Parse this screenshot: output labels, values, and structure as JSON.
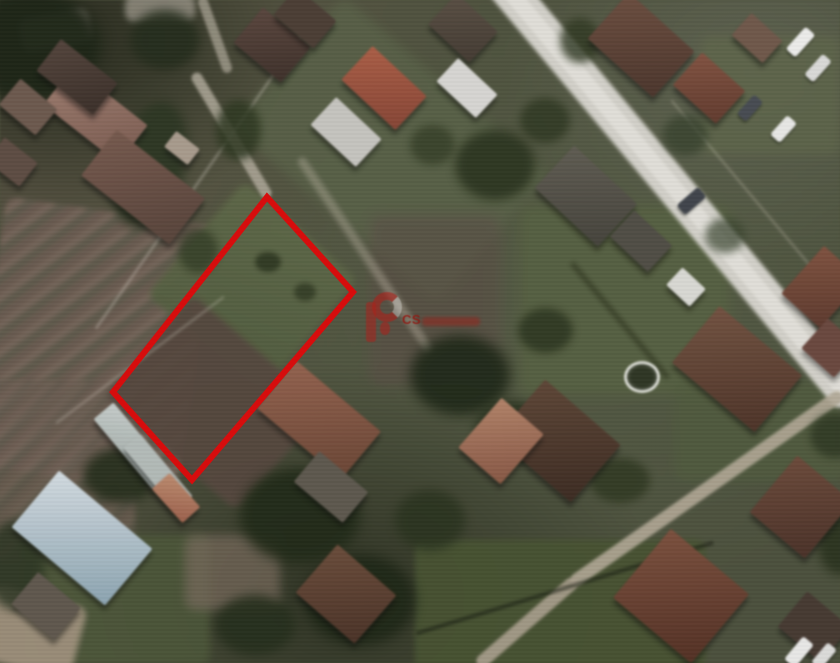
{
  "meta": {
    "kind": "aerial-photo-with-plot-outline",
    "width": 840,
    "height": 663
  },
  "watermark": {
    "text": "CS",
    "logo_color": "#b21e18",
    "word_color": "rgba(160,30,22,0.5)"
  },
  "plot_outline": {
    "points": "267,197 353,292 192,480 113,392",
    "stroke": "#d60d0d",
    "stroke_width": 6
  },
  "scene": {
    "fields": [
      {
        "n": "plowed-field-left",
        "x": 92,
        "y": 345,
        "w": 210,
        "h": 270,
        "rot": 8,
        "bg": "repeating-linear-gradient(135deg,#6c5a4f 0px 8px,#79665a 8px 14px,#60594b 14px 22px)",
        "op": 0.9,
        "blur": 2
      },
      {
        "n": "plowed-field-left-lower",
        "x": 55,
        "y": 470,
        "w": 160,
        "h": 180,
        "rot": 0,
        "bg": "repeating-linear-gradient(135deg,#6c5a4f 0px 8px,#746256 8px 15px,#5e574a 15px 22px)",
        "op": 0.7,
        "blur": 3
      },
      {
        "n": "marked-plot-upper-grass",
        "x": 252,
        "y": 287,
        "w": 150,
        "h": 150,
        "rot": 41,
        "bg": "linear-gradient(160deg,#5d6844,#505c3c)",
        "op": 0.95,
        "blur": 3
      },
      {
        "n": "marked-plot-lower-soil",
        "x": 214,
        "y": 402,
        "w": 175,
        "h": 135,
        "rot": 41,
        "bg": "#55463c",
        "op": 0.95,
        "blur": 3
      },
      {
        "n": "grass-band-top-center",
        "x": 390,
        "y": 150,
        "w": 270,
        "h": 170,
        "rot": 41,
        "bg": "#586245",
        "op": 0.8,
        "blur": 5
      },
      {
        "n": "lawn-right",
        "x": 625,
        "y": 300,
        "w": 210,
        "h": 190,
        "rot": 0,
        "bg": "#55613e",
        "op": 0.85,
        "blur": 6
      },
      {
        "n": "lawn-right-lower",
        "x": 760,
        "y": 430,
        "w": 170,
        "h": 100,
        "rot": 0,
        "bg": "#4f5b3b",
        "op": 0.8,
        "blur": 5
      },
      {
        "n": "green-field-bottom",
        "x": 560,
        "y": 615,
        "w": 290,
        "h": 150,
        "rot": 0,
        "bg": "#45512e",
        "op": 0.95,
        "blur": 3
      },
      {
        "n": "green-bottom-left",
        "x": 115,
        "y": 600,
        "w": 190,
        "h": 130,
        "rot": 0,
        "bg": "#4a5636",
        "op": 0.85,
        "blur": 4
      },
      {
        "n": "dirt-bottom-left-corner",
        "x": 32,
        "y": 632,
        "w": 95,
        "h": 75,
        "rot": 15,
        "bg": "#a2927c",
        "op": 0.9,
        "blur": 3
      },
      {
        "n": "dirt-patch-bottom-center",
        "x": 232,
        "y": 572,
        "w": 95,
        "h": 75,
        "rot": 0,
        "bg": "#79695a",
        "op": 0.7,
        "blur": 5
      },
      {
        "n": "soil-right-of-plot",
        "x": 435,
        "y": 300,
        "w": 130,
        "h": 170,
        "rot": 0,
        "bg": "#5a4c43",
        "op": 0.6,
        "blur": 6
      },
      {
        "n": "lawn-top-right-parking",
        "x": 770,
        "y": 95,
        "w": 140,
        "h": 120,
        "rot": 0,
        "bg": "#5e6747",
        "op": 0.7,
        "blur": 5
      },
      {
        "n": "bare-patch-top-left",
        "x": 55,
        "y": 30,
        "w": 70,
        "h": 35,
        "rot": -10,
        "bg": "#9b958a",
        "op": 0.7,
        "blur": 3
      },
      {
        "n": "bare-patch-top",
        "x": 160,
        "y": 8,
        "w": 70,
        "h": 28,
        "rot": 0,
        "bg": "#a39d90",
        "op": 0.7,
        "blur": 3
      }
    ],
    "roads": [
      {
        "n": "main-road",
        "x": 672,
        "y": 185,
        "w": 560,
        "h": 36,
        "rot": 50,
        "bg": "#d3d1c9",
        "op": 1,
        "blur": 1.5
      },
      {
        "n": "main-road-center",
        "x": 672,
        "y": 185,
        "w": 560,
        "h": 16,
        "rot": 50,
        "bg": "#e3e1da",
        "op": 0.9,
        "blur": 1
      },
      {
        "n": "side-road-lower-right",
        "x": 707,
        "y": 488,
        "w": 330,
        "h": 13,
        "rot": -35,
        "bg": "#b2a894",
        "op": 0.9,
        "blur": 1
      },
      {
        "n": "side-road-bottom",
        "x": 527,
        "y": 622,
        "w": 130,
        "h": 13,
        "rot": -41,
        "bg": "#ab9f8c",
        "op": 0.9,
        "blur": 1
      },
      {
        "n": "lane-to-plot",
        "x": 231,
        "y": 135,
        "w": 145,
        "h": 11,
        "rot": 59,
        "bg": "#b5ae9e",
        "op": 0.8,
        "blur": 1
      },
      {
        "n": "lane-top-stub",
        "x": 215,
        "y": 35,
        "w": 80,
        "h": 10,
        "rot": 70,
        "bg": "#b0a999",
        "op": 0.7,
        "blur": 1
      },
      {
        "n": "dirt-track-center",
        "x": 365,
        "y": 255,
        "w": 235,
        "h": 9,
        "rot": 56,
        "bg": "#a59f8d",
        "op": 0.5,
        "blur": 2
      }
    ],
    "lines": [
      {
        "n": "fence-line-left",
        "x": 202,
        "y": 177,
        "w": 370,
        "h": 2,
        "rot": -55,
        "bg": "rgba(205,200,185,0.5)",
        "op": 1,
        "blur": 1
      },
      {
        "n": "fence-line-greenhouse",
        "x": 140,
        "y": 360,
        "w": 210,
        "h": 2,
        "rot": -37,
        "bg": "rgba(200,195,180,0.4)",
        "op": 1,
        "blur": 1
      },
      {
        "n": "roof-ridge-red-house",
        "x": 384,
        "y": 88,
        "w": 66,
        "h": 3,
        "rot": 43,
        "bg": "rgba(230,222,210,0.8)",
        "op": 1,
        "blur": 0
      },
      {
        "n": "roof-ridge-brown-house",
        "x": 319,
        "y": 418,
        "w": 95,
        "h": 3,
        "rot": 40,
        "bg": "rgba(215,200,180,0.5)",
        "op": 1,
        "blur": 0
      },
      {
        "n": "field-edge-dark",
        "x": 565,
        "y": 588,
        "w": 310,
        "h": 4,
        "rot": -17,
        "bg": "rgba(20,26,12,0.55)",
        "op": 1,
        "blur": 1
      },
      {
        "n": "hedge-dark-right",
        "x": 620,
        "y": 320,
        "w": 150,
        "h": 5,
        "rot": 50,
        "bg": "rgba(25,32,16,0.5)",
        "op": 1,
        "blur": 2
      },
      {
        "n": "fence-along-road",
        "x": 755,
        "y": 200,
        "w": 260,
        "h": 2,
        "rot": 50,
        "bg": "rgba(210,205,190,0.35)",
        "op": 1,
        "blur": 1
      }
    ],
    "trees": [
      {
        "n": "tree-cluster",
        "x": 30,
        "y": 45,
        "w": 140,
        "h": 110,
        "bg": "#1c2414",
        "op": 0.95,
        "blur": 6
      },
      {
        "n": "tree-cluster",
        "x": 165,
        "y": 40,
        "w": 70,
        "h": 60,
        "bg": "#232c1a",
        "op": 0.9,
        "blur": 5
      },
      {
        "n": "tree-band",
        "x": 150,
        "y": 165,
        "w": 70,
        "h": 130,
        "rot": 15,
        "bg": "#2a3520",
        "op": 0.9,
        "blur": 5
      },
      {
        "n": "tree",
        "x": 238,
        "y": 130,
        "w": 45,
        "h": 60,
        "bg": "#2c371f",
        "op": 0.85,
        "blur": 4
      },
      {
        "n": "tree",
        "x": 198,
        "y": 250,
        "w": 40,
        "h": 45,
        "bg": "#313c24",
        "op": 0.8,
        "blur": 4
      },
      {
        "n": "tree-in-plot",
        "x": 268,
        "y": 262,
        "w": 26,
        "h": 20,
        "bg": "#2c361f",
        "op": 0.9,
        "blur": 2
      },
      {
        "n": "tree-in-plot",
        "x": 305,
        "y": 292,
        "w": 22,
        "h": 18,
        "bg": "#303a22",
        "op": 0.85,
        "blur": 2
      },
      {
        "n": "tree-cluster",
        "x": 495,
        "y": 165,
        "w": 80,
        "h": 70,
        "bg": "#29331d",
        "op": 0.9,
        "blur": 5
      },
      {
        "n": "tree",
        "x": 545,
        "y": 120,
        "w": 50,
        "h": 45,
        "bg": "#2e3821",
        "op": 0.85,
        "blur": 4
      },
      {
        "n": "tree",
        "x": 432,
        "y": 145,
        "w": 45,
        "h": 40,
        "bg": "#333d25",
        "op": 0.8,
        "blur": 4
      },
      {
        "n": "tree",
        "x": 580,
        "y": 40,
        "w": 40,
        "h": 45,
        "bg": "#2e3820",
        "op": 0.8,
        "blur": 4
      },
      {
        "n": "tree-cluster",
        "x": 460,
        "y": 375,
        "w": 100,
        "h": 80,
        "bg": "#1f2917",
        "op": 0.95,
        "blur": 6
      },
      {
        "n": "tree",
        "x": 510,
        "y": 430,
        "w": 70,
        "h": 60,
        "bg": "#27311c",
        "op": 0.9,
        "blur": 5
      },
      {
        "n": "tree",
        "x": 545,
        "y": 330,
        "w": 55,
        "h": 45,
        "bg": "#2a341e",
        "op": 0.85,
        "blur": 4
      },
      {
        "n": "tree-cluster",
        "x": 300,
        "y": 515,
        "w": 120,
        "h": 95,
        "bg": "#202a16",
        "op": 0.95,
        "blur": 6
      },
      {
        "n": "tree-cluster",
        "x": 360,
        "y": 600,
        "w": 110,
        "h": 90,
        "bg": "#1d2614",
        "op": 0.95,
        "blur": 6
      },
      {
        "n": "tree",
        "x": 255,
        "y": 625,
        "w": 80,
        "h": 60,
        "bg": "#242e1a",
        "op": 0.9,
        "blur": 5
      },
      {
        "n": "tree",
        "x": 430,
        "y": 520,
        "w": 70,
        "h": 60,
        "bg": "#28321c",
        "op": 0.85,
        "blur": 5
      },
      {
        "n": "tree",
        "x": 120,
        "y": 475,
        "w": 75,
        "h": 55,
        "bg": "#232d19",
        "op": 0.9,
        "blur": 5
      },
      {
        "n": "tree",
        "x": 15,
        "y": 565,
        "w": 60,
        "h": 90,
        "bg": "#2a3420",
        "op": 0.85,
        "blur": 5
      },
      {
        "n": "tree",
        "x": 685,
        "y": 135,
        "w": 45,
        "h": 40,
        "bg": "#34402a",
        "op": 0.75,
        "blur": 4
      },
      {
        "n": "tree",
        "x": 725,
        "y": 235,
        "w": 40,
        "h": 35,
        "bg": "#37432c",
        "op": 0.7,
        "blur": 4
      },
      {
        "n": "tree",
        "x": 835,
        "y": 435,
        "w": 50,
        "h": 45,
        "bg": "#2b351f",
        "op": 0.8,
        "blur": 4
      },
      {
        "n": "tree",
        "x": 620,
        "y": 480,
        "w": 60,
        "h": 45,
        "bg": "#2c361e",
        "op": 0.8,
        "blur": 4
      },
      {
        "n": "tree",
        "x": 840,
        "y": 545,
        "w": 45,
        "h": 60,
        "bg": "#26301a",
        "op": 0.85,
        "blur": 5
      }
    ],
    "houses": [
      {
        "n": "house-rose-roof",
        "x": 95,
        "y": 115,
        "w": 95,
        "h": 48,
        "rot": 38,
        "bg": "linear-gradient(128deg,#a07b6d,#7b5a4e)"
      },
      {
        "n": "house",
        "x": 143,
        "y": 187,
        "w": 112,
        "h": 58,
        "rot": 38,
        "bg": "linear-gradient(128deg,#77584a,#584238)"
      },
      {
        "n": "house",
        "x": 77,
        "y": 77,
        "w": 72,
        "h": 40,
        "rot": 38,
        "bg": "linear-gradient(128deg,#53423a,#3b2e28)"
      },
      {
        "n": "house",
        "x": 28,
        "y": 107,
        "w": 48,
        "h": 34,
        "rot": 40,
        "bg": "#6d584c"
      },
      {
        "n": "house",
        "x": 12,
        "y": 162,
        "w": 42,
        "h": 30,
        "rot": 38,
        "bg": "#5e4b41"
      },
      {
        "n": "shed",
        "x": 182,
        "y": 148,
        "w": 30,
        "h": 20,
        "rot": 38,
        "bg": "#a99a8b"
      },
      {
        "n": "house",
        "x": 272,
        "y": 45,
        "w": 62,
        "h": 46,
        "rot": 40,
        "bg": "linear-gradient(135deg,#5a443c,#3e2f29)"
      },
      {
        "n": "house-red-roof",
        "x": 384,
        "y": 88,
        "w": 74,
        "h": 46,
        "rot": 43,
        "bg": "linear-gradient(135deg,#b05c42,#8a4332)"
      },
      {
        "n": "shed-gray",
        "x": 346,
        "y": 132,
        "w": 62,
        "h": 38,
        "rot": 43,
        "bg": "#c6c4bf"
      },
      {
        "n": "house",
        "x": 305,
        "y": 18,
        "w": 52,
        "h": 36,
        "rot": 40,
        "bg": "#4b3c33"
      },
      {
        "n": "house",
        "x": 463,
        "y": 28,
        "w": 56,
        "h": 42,
        "rot": 43,
        "bg": "linear-gradient(135deg,#5a4e42,#433a31)"
      },
      {
        "n": "building-white",
        "x": 467,
        "y": 88,
        "w": 54,
        "h": 32,
        "rot": 43,
        "bg": "#d7d6d2"
      },
      {
        "n": "house",
        "x": 641,
        "y": 45,
        "w": 88,
        "h": 62,
        "rot": 42,
        "bg": "linear-gradient(135deg,#6e4c3d,#4c342a)"
      },
      {
        "n": "house",
        "x": 709,
        "y": 88,
        "w": 58,
        "h": 44,
        "rot": 42,
        "bg": "linear-gradient(135deg,#84503e,#63392c)"
      },
      {
        "n": "house",
        "x": 757,
        "y": 38,
        "w": 42,
        "h": 30,
        "rot": 42,
        "bg": "#705747"
      },
      {
        "n": "house-gray-roof",
        "x": 586,
        "y": 196,
        "w": 86,
        "h": 58,
        "rot": 43,
        "bg": "linear-gradient(135deg,#5f5b50,#44423a)"
      },
      {
        "n": "house",
        "x": 641,
        "y": 241,
        "w": 52,
        "h": 36,
        "rot": 43,
        "bg": "#4f4c43"
      },
      {
        "n": "house",
        "x": 822,
        "y": 287,
        "w": 52,
        "h": 64,
        "rot": 42,
        "bg": "linear-gradient(135deg,#82503c,#5f382c)"
      },
      {
        "n": "house",
        "x": 831,
        "y": 348,
        "w": 44,
        "h": 40,
        "rot": 42,
        "bg": "#6c463c"
      },
      {
        "n": "white-object",
        "x": 686,
        "y": 287,
        "w": 32,
        "h": 24,
        "rot": 43,
        "bg": "#d9d9d3"
      },
      {
        "n": "house-hip-roof",
        "x": 737,
        "y": 369,
        "w": 108,
        "h": 74,
        "rot": 40,
        "bg": "linear-gradient(135deg,#74503e,#4e3226)"
      },
      {
        "n": "house",
        "x": 558,
        "y": 441,
        "w": 100,
        "h": 76,
        "rot": 41,
        "bg": "linear-gradient(135deg,#5f4434,#3c2a20)"
      },
      {
        "n": "house-salmon-roof",
        "x": 501,
        "y": 441,
        "w": 56,
        "h": 66,
        "rot": 41,
        "bg": "linear-gradient(135deg,#b58166,#8a5640)"
      },
      {
        "n": "house-below-plot",
        "x": 319,
        "y": 420,
        "w": 110,
        "h": 62,
        "rot": 40,
        "bg": "linear-gradient(135deg,#96614a,#6c4332)"
      },
      {
        "n": "house",
        "x": 331,
        "y": 487,
        "w": 64,
        "h": 40,
        "rot": 40,
        "bg": "#5d574c"
      },
      {
        "n": "house",
        "x": 346,
        "y": 594,
        "w": 78,
        "h": 64,
        "rot": 41,
        "bg": "linear-gradient(135deg,#6c4a38,#4b3125)"
      },
      {
        "n": "house-hip-roof",
        "x": 681,
        "y": 596,
        "w": 102,
        "h": 90,
        "rot": 40,
        "bg": "linear-gradient(135deg,#7e4e3a,#552f22)"
      },
      {
        "n": "house",
        "x": 801,
        "y": 507,
        "w": 72,
        "h": 74,
        "rot": 40,
        "bg": "linear-gradient(135deg,#6e4838,#4b3026)"
      },
      {
        "n": "house",
        "x": 814,
        "y": 627,
        "w": 56,
        "h": 46,
        "rot": 40,
        "bg": "#463830"
      },
      {
        "n": "greenhouse",
        "x": 133,
        "y": 446,
        "w": 92,
        "h": 26,
        "rot": 50,
        "bg": "linear-gradient(140deg,#c6cdca,#98a3a0)"
      },
      {
        "n": "greenhouse",
        "x": 158,
        "y": 472,
        "w": 82,
        "h": 22,
        "rot": 50,
        "bg": "#b4bcb9",
        "op": 0.9
      },
      {
        "n": "house-blue-roof",
        "x": 82,
        "y": 538,
        "w": 122,
        "h": 74,
        "rot": 40,
        "bg": "linear-gradient(140deg,#d3dce1,#8aa4b2)"
      },
      {
        "n": "shed-red-roof",
        "x": 176,
        "y": 498,
        "w": 46,
        "h": 24,
        "rot": 48,
        "bg": "linear-gradient(140deg,#c08a6b,#a05f48)"
      },
      {
        "n": "house",
        "x": 46,
        "y": 606,
        "w": 56,
        "h": 42,
        "rot": 40,
        "bg": "#5f564b"
      }
    ],
    "cars": [
      {
        "n": "car-white",
        "x": 800,
        "y": 42,
        "w": 13,
        "h": 30,
        "rot": 42,
        "bg": "#ededeb"
      },
      {
        "n": "car-white",
        "x": 818,
        "y": 68,
        "w": 12,
        "h": 28,
        "rot": 42,
        "bg": "#dadad8"
      },
      {
        "n": "car-dark",
        "x": 750,
        "y": 108,
        "w": 12,
        "h": 26,
        "rot": 42,
        "bg": "#454a52"
      },
      {
        "n": "car-white",
        "x": 783,
        "y": 129,
        "w": 13,
        "h": 26,
        "rot": 42,
        "bg": "#e8e8e6"
      },
      {
        "n": "car-on-road",
        "x": 691,
        "y": 201,
        "w": 13,
        "h": 28,
        "rot": 49,
        "bg": "#3e434b"
      },
      {
        "n": "car-white",
        "x": 799,
        "y": 652,
        "w": 14,
        "h": 30,
        "rot": 40,
        "bg": "#e9e9e7"
      },
      {
        "n": "car-white",
        "x": 824,
        "y": 656,
        "w": 12,
        "h": 26,
        "rot": 40,
        "bg": "#dcdcda"
      }
    ],
    "objects": [
      {
        "n": "trampoline-ring",
        "x": 639,
        "y": 374,
        "w": 30,
        "h": 26,
        "bg": ""
      }
    ]
  }
}
